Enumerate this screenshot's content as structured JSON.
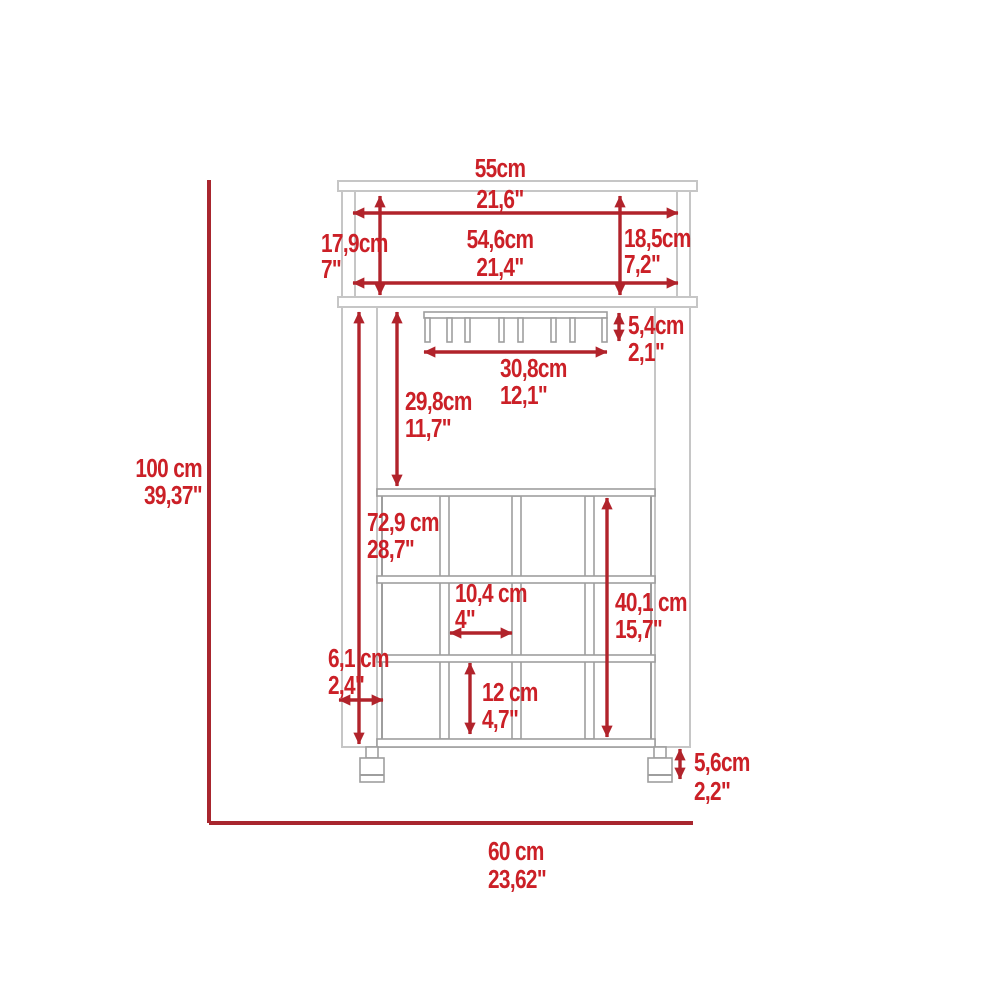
{
  "diagram": {
    "kind": "furniture-dimension-drawing",
    "subject": "bar cart with stemware rack and wine cubbies, front elevation",
    "units": [
      "cm",
      "inches"
    ]
  },
  "colors": {
    "dimension_red_line": "#a8262e",
    "dimension_red_arrow": "#b1232b",
    "dimension_red_text": "#cb2027",
    "outline_gray_light": "#c6c6c6",
    "outline_gray_dark": "#9e9e9e",
    "background": "#ffffff"
  },
  "labels": {
    "top_width": {
      "cm": "55cm",
      "in": "21,6\""
    },
    "top_inner_width": {
      "cm": "54,6cm",
      "in": "21,4\""
    },
    "hutch_left_height": {
      "cm": "17,9cm",
      "in": "7\""
    },
    "hutch_right_height": {
      "cm": "18,5cm",
      "in": "7,2\""
    },
    "stemware_rack_height": {
      "cm": "5,4cm",
      "in": "2,1\""
    },
    "stemware_rack_width": {
      "cm": "30,8cm",
      "in": "12,1\""
    },
    "upper_cavity_height": {
      "cm": "29,8cm",
      "in": "11,7\""
    },
    "body_interior_height": {
      "cm": "72,9 cm",
      "in": "28,7\""
    },
    "cubby_width": {
      "cm": "10,4 cm",
      "in": "4\""
    },
    "cubby_height": {
      "cm": "12 cm",
      "in": "4,7\""
    },
    "wine_rack_height": {
      "cm": "40,1 cm",
      "in": "15,7\""
    },
    "side_panel_width": {
      "cm": "6,1 cm",
      "in": "2,4\""
    },
    "caster_height": {
      "cm": "5,6cm",
      "in": "2,2\""
    },
    "overall_height": {
      "cm": "100 cm",
      "in": "39,37\""
    },
    "overall_width": {
      "cm": "60 cm",
      "in": "23,62\""
    }
  }
}
